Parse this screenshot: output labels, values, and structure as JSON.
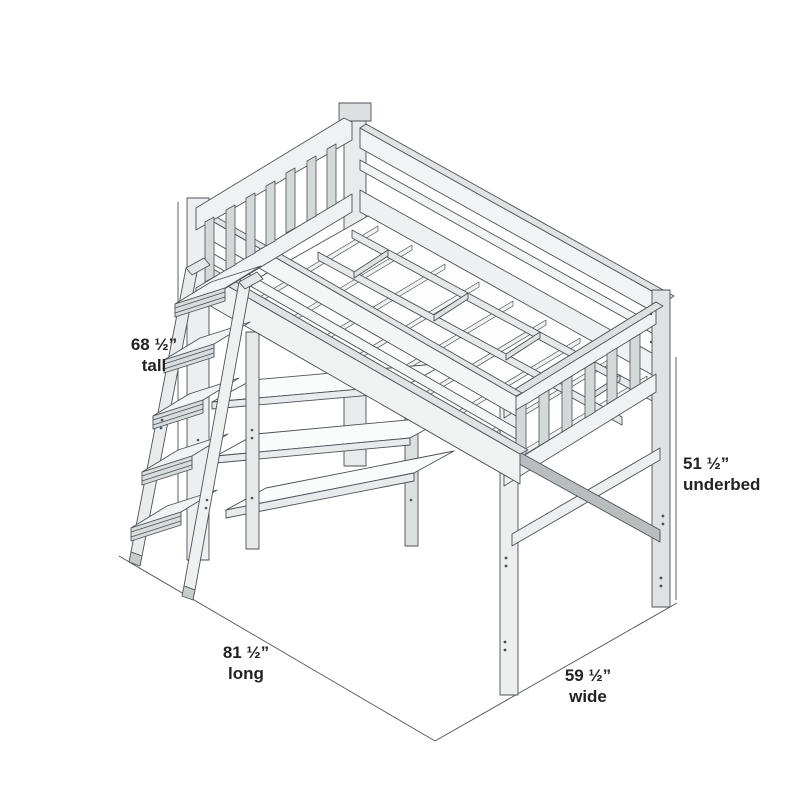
{
  "canvas": {
    "background": "#ffffff"
  },
  "drawing": {
    "subject": "isometric-loft-bed-line-drawing",
    "parts": [
      "headboard",
      "back-guard-rail",
      "slatted-deck",
      "footboard",
      "front-guard-rail",
      "under-bed-bookshelf",
      "ladder",
      "cross-braced-legs"
    ],
    "stroke_color": "#4d5156",
    "text_color": "#232323"
  },
  "dimensions": {
    "tall": {
      "value": "68 ½”",
      "label": "tall"
    },
    "underbed": {
      "value": "51 ½”",
      "label": "underbed"
    },
    "long": {
      "value": "81 ½”",
      "label": "long"
    },
    "wide": {
      "value": "59 ½”",
      "label": "wide"
    }
  }
}
